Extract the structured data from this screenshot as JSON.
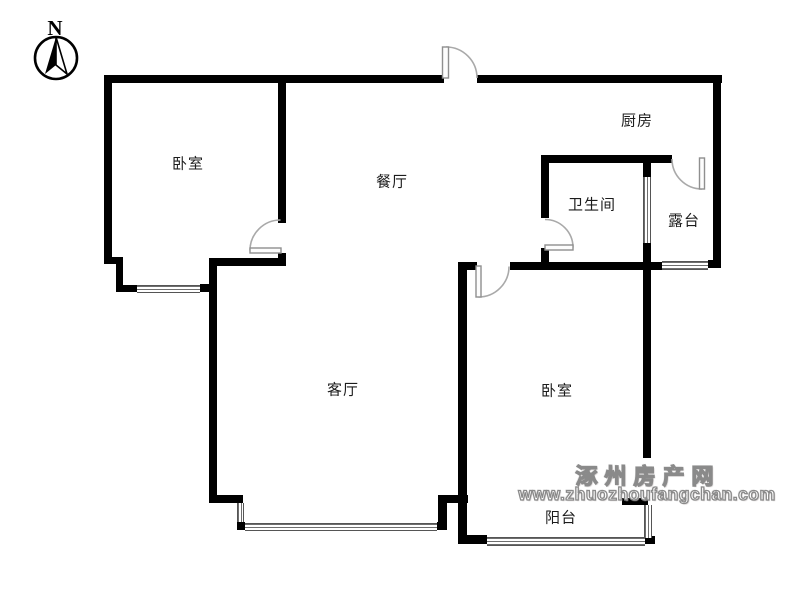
{
  "compass": {
    "label": "N"
  },
  "rooms": [
    {
      "id": "bedroom-1",
      "label": "卧室",
      "x": 188,
      "y": 163
    },
    {
      "id": "dining",
      "label": "餐厅",
      "x": 392,
      "y": 181
    },
    {
      "id": "kitchen",
      "label": "厨房",
      "x": 637,
      "y": 120
    },
    {
      "id": "bathroom",
      "label": "卫生间",
      "x": 592,
      "y": 204
    },
    {
      "id": "terrace",
      "label": "露台",
      "x": 684,
      "y": 220
    },
    {
      "id": "living",
      "label": "客厅",
      "x": 343,
      "y": 389
    },
    {
      "id": "bedroom-2",
      "label": "卧室",
      "x": 557,
      "y": 390
    },
    {
      "id": "balcony",
      "label": "阳台",
      "x": 561,
      "y": 517
    }
  ],
  "watermark": {
    "title": "涿州房产网",
    "url": "www.zhuozhoufangchan.com"
  },
  "colors": {
    "wall": "#000000",
    "door": "#a9a9a9",
    "window_line": "#6e6e6e",
    "watermark": "#8a8a8a",
    "label_text": "#1c1c1c"
  }
}
